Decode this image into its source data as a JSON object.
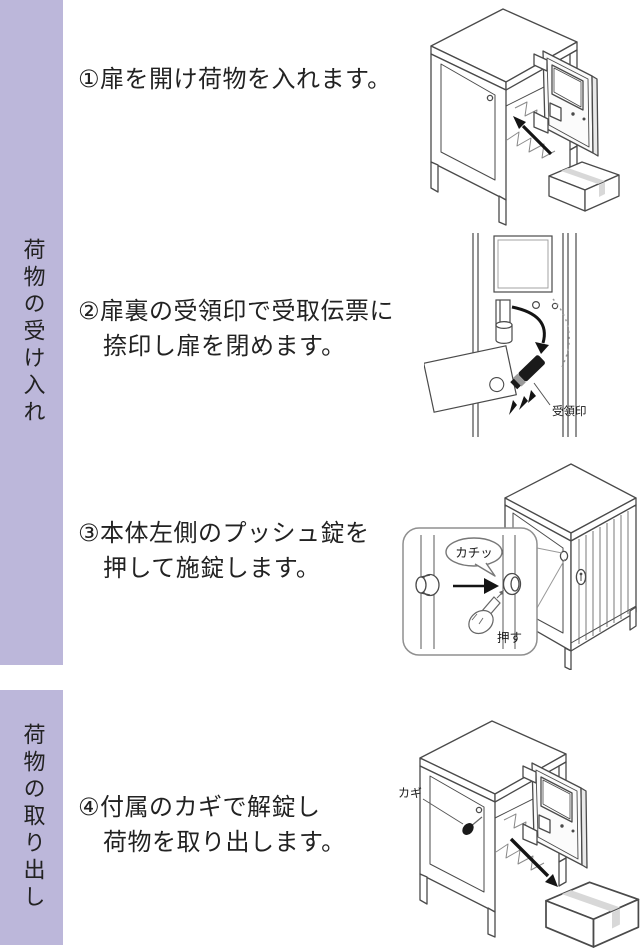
{
  "banners": [
    {
      "label": "荷物の受け入れ"
    },
    {
      "label": "荷物の取り出し"
    }
  ],
  "steps": [
    {
      "lines": [
        "①扉を開け荷物を入れます。"
      ]
    },
    {
      "lines": [
        "②扉裏の受領印で受取伝票に",
        "捺印し扉を閉めます。"
      ]
    },
    {
      "lines": [
        "③本体左側のプッシュ錠を",
        "押して施錠します。"
      ]
    },
    {
      "lines": [
        "④付属のカギで解錠し",
        "荷物を取り出します。"
      ]
    }
  ],
  "illustrations": {
    "step2": {
      "stamp_label": "受領印"
    },
    "step3": {
      "click_label": "カチッ",
      "push_label": "押す"
    },
    "step4": {
      "key_label": "カギ"
    }
  },
  "colors": {
    "banner_bg": "#bcb7da",
    "text": "#222222",
    "line_art": "#4a4a4a"
  }
}
